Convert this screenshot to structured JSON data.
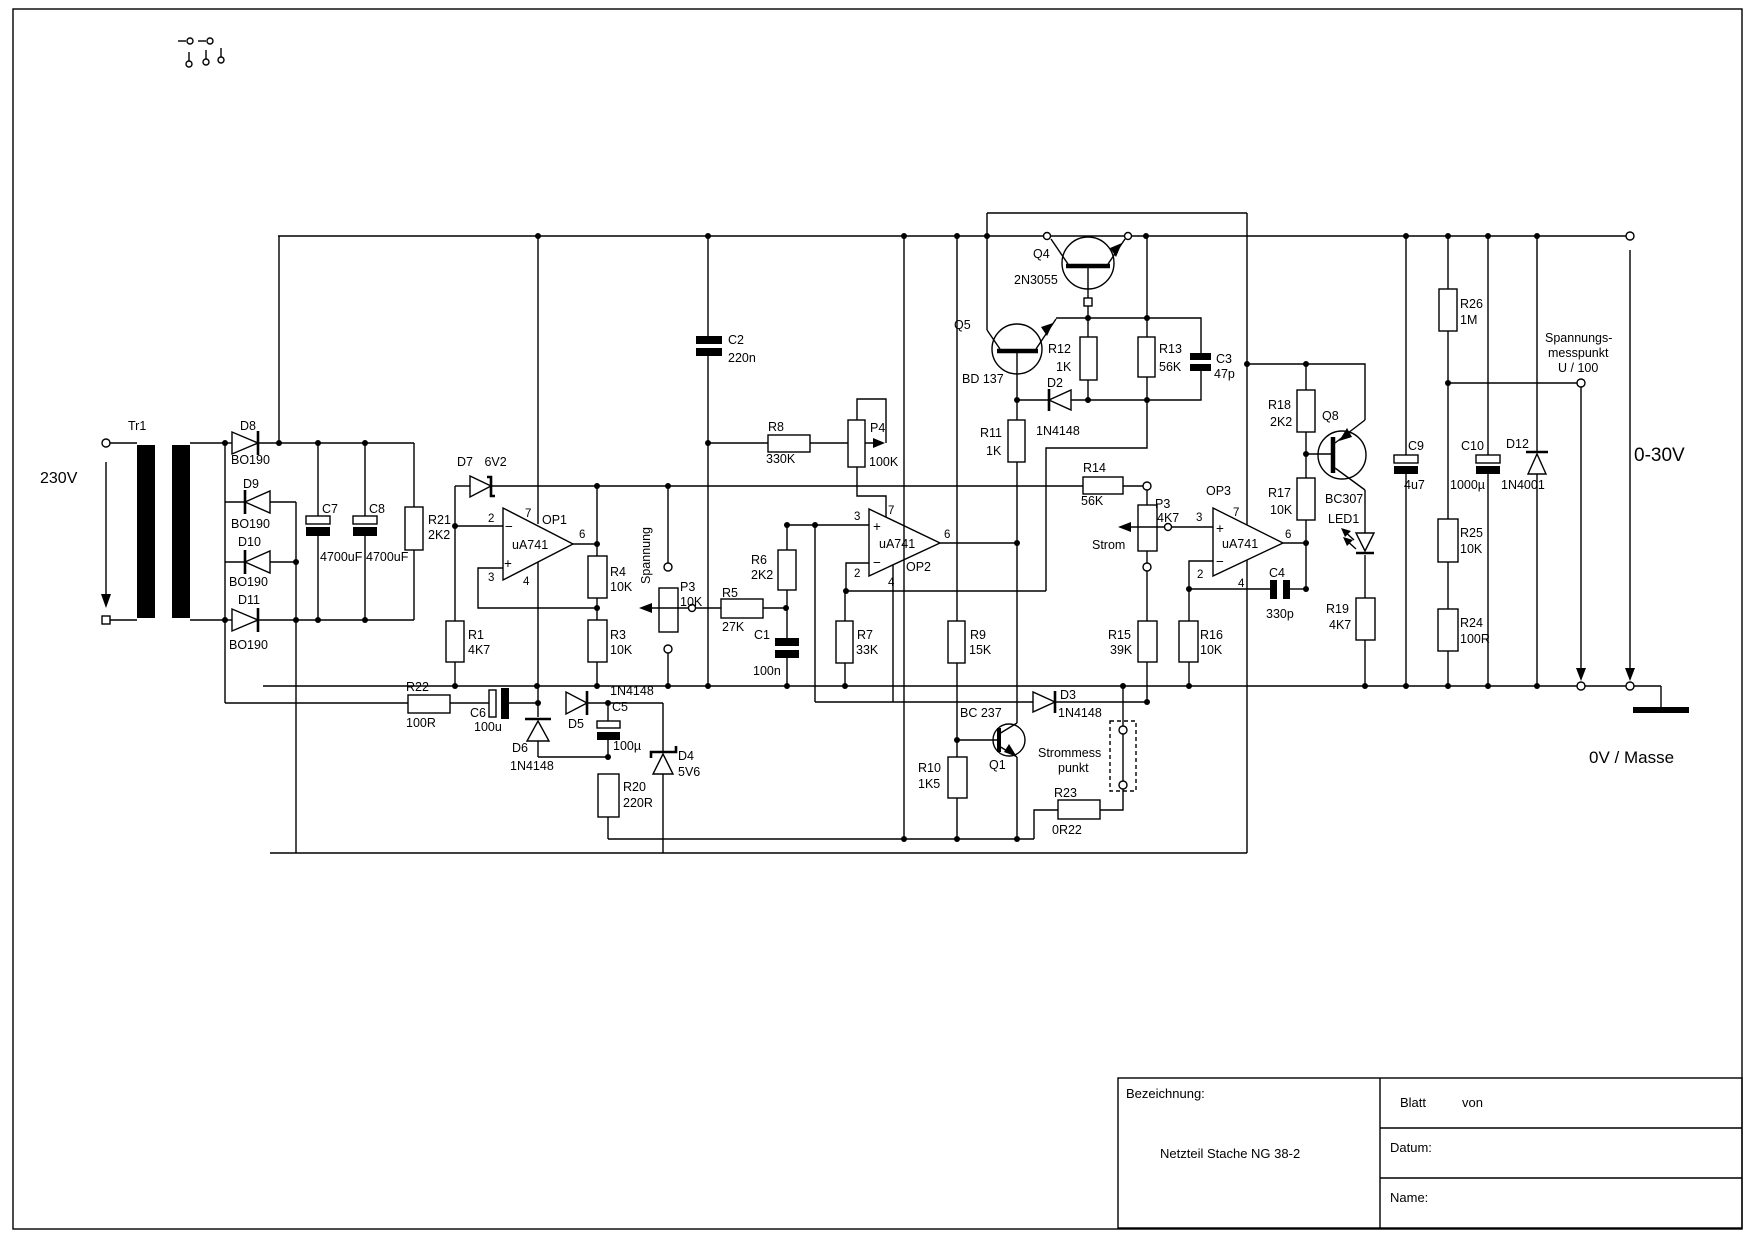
{
  "components": {
    "r1": {
      "n": "R1",
      "v": "4K7"
    },
    "r3": {
      "n": "R3",
      "v": "10K"
    },
    "r4": {
      "n": "R4",
      "v": "10K"
    },
    "r5": {
      "n": "R5",
      "v": "27K"
    },
    "r6": {
      "n": "R6",
      "v": "2K2"
    },
    "r7": {
      "n": "R7",
      "v": "33K"
    },
    "r8": {
      "n": "R8",
      "v": "330K"
    },
    "r9": {
      "n": "R9",
      "v": "15K"
    },
    "r10": {
      "n": "R10",
      "v": "1K5"
    },
    "r11": {
      "n": "R11",
      "v": "1K"
    },
    "r12": {
      "n": "R12",
      "v": "1K"
    },
    "r13": {
      "n": "R13",
      "v": "56K"
    },
    "r14": {
      "n": "R14",
      "v": "56K"
    },
    "r15": {
      "n": "R15",
      "v": "39K"
    },
    "r16": {
      "n": "R16",
      "v": "10K"
    },
    "r17": {
      "n": "R17",
      "v": "10K"
    },
    "r18": {
      "n": "R18",
      "v": "2K2"
    },
    "r19": {
      "n": "R19",
      "v": "4K7"
    },
    "r20": {
      "n": "R20",
      "v": "220R"
    },
    "r21": {
      "n": "R21",
      "v": "2K2"
    },
    "r22": {
      "n": "R22",
      "v": "100R"
    },
    "r23": {
      "n": "R23",
      "v": "0R22"
    },
    "r24": {
      "n": "R24",
      "v": "100R"
    },
    "r25": {
      "n": "R25",
      "v": "10K"
    },
    "r26": {
      "n": "R26",
      "v": "1M"
    },
    "p3a": {
      "n": "P3",
      "v": "10K"
    },
    "p3b": {
      "n": "P3",
      "v": "4K7"
    },
    "p4": {
      "n": "P4",
      "v": "100K"
    },
    "c1": {
      "n": "C1",
      "v": "100n"
    },
    "c2": {
      "n": "C2",
      "v": "220n"
    },
    "c3": {
      "n": "C3",
      "v": "47p"
    },
    "c4": {
      "n": "C4",
      "v": "330p"
    },
    "c5": {
      "n": "C5",
      "v": "100µ"
    },
    "c6": {
      "n": "C6",
      "v": "100u"
    },
    "c7": {
      "n": "C7",
      "v": "4700uF"
    },
    "c8": {
      "n": "C8",
      "v": "4700uF"
    },
    "c9": {
      "n": "C9",
      "v": "4u7"
    },
    "c10": {
      "n": "C10",
      "v": "1000µ"
    },
    "d2": {
      "n": "D2",
      "v": "1N4148"
    },
    "d3": {
      "n": "D3",
      "v": "1N4148"
    },
    "d4": {
      "n": "D4",
      "v": "5V6"
    },
    "d5": {
      "n": "D5",
      "v": "1N4148"
    },
    "d6": {
      "n": "D6",
      "v": "1N4148"
    },
    "d7": {
      "n": "D7",
      "v": "6V2"
    },
    "d8": {
      "n": "D8",
      "v": "BO190"
    },
    "d9": {
      "n": "D9",
      "v": "BO190"
    },
    "d10": {
      "n": "D10",
      "v": "BO190"
    },
    "d11": {
      "n": "D11",
      "v": "BO190"
    },
    "d12": {
      "n": "D12",
      "v": "1N4001"
    },
    "q1": {
      "n": "Q1",
      "t": "BC 237"
    },
    "q4": {
      "n": "Q4",
      "t": "2N3055"
    },
    "q5": {
      "n": "Q5",
      "t": "BD 137"
    },
    "q8": {
      "n": "Q8",
      "t": "BC307"
    },
    "op1": {
      "n": "OP1",
      "ic": "uA741"
    },
    "op2": {
      "n": "OP2",
      "ic": "uA741"
    },
    "op3": {
      "n": "OP3",
      "ic": "uA741"
    },
    "tr1": {
      "n": "Tr1"
    },
    "led1": {
      "n": "LED1"
    }
  },
  "pins": {
    "p2": "2",
    "p3": "3",
    "p4": "4",
    "p6": "6",
    "p7": "7",
    "plus": "+",
    "minus": "−"
  },
  "texts": {
    "v230": "230V",
    "spannung": "Spannung",
    "strom": "Strom",
    "strommess1": "Strommess",
    "strommess2": "punkt",
    "mess1": "Spannungs-",
    "mess2": "messpunkt",
    "mess3": "U / 100",
    "range": "0-30V",
    "masse": "0V / Masse"
  },
  "titleblock": {
    "bezeichnung": "Bezeichnung:",
    "title": "Netzteil Stache NG 38-2",
    "blatt": "Blatt",
    "von": "von",
    "datum": "Datum:",
    "name": "Name:"
  },
  "colors": {
    "ink": "#000000",
    "paper": "#ffffff"
  }
}
